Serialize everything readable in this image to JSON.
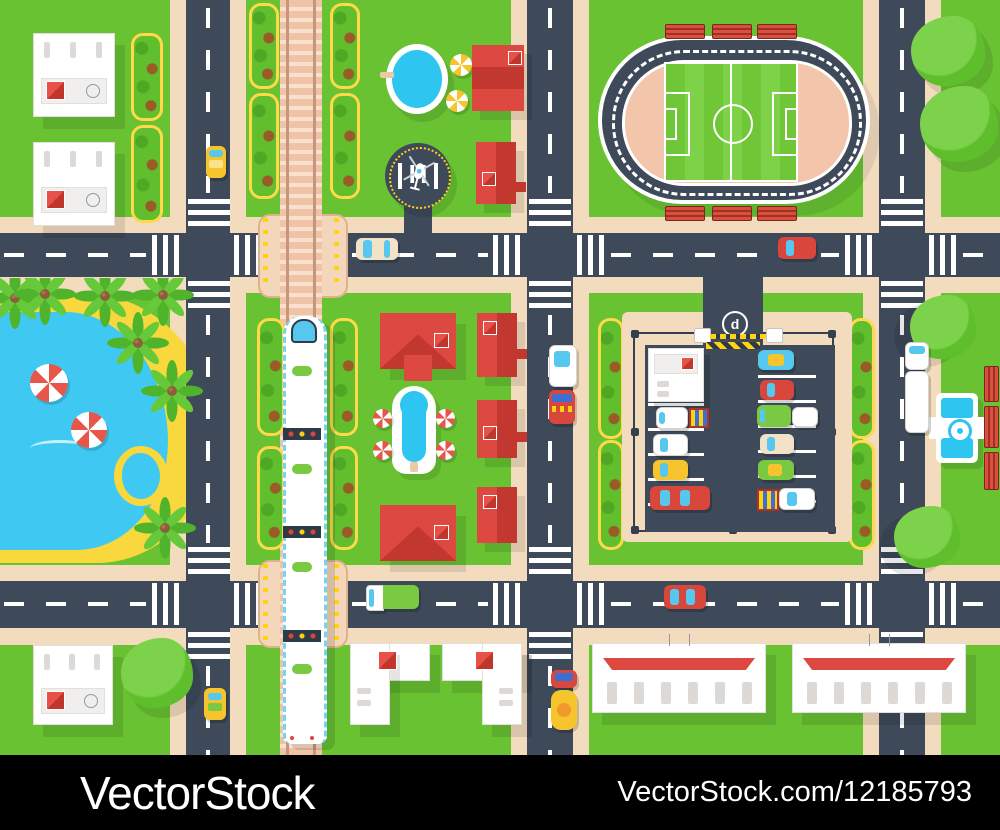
{
  "page": {
    "type": "stock-vector-preview",
    "subject": "City map top view with roads, railway train, stadium, parking lot, beach and buildings"
  },
  "watermark": {
    "brand_text": "VectorStock",
    "id_text": "VectorStock.com/12185793",
    "bar_color": "#000000",
    "text_color": "#FFFFFF"
  },
  "map": {
    "signs": {
      "helipad_letter": "H",
      "parking_sign_letter": "d"
    },
    "palette": {
      "grass": "#68C232",
      "grass_stripe": "#77CD40",
      "road": "#3E4A5A",
      "road_marking": "#FFFFFF",
      "sidewalk": "#F3DCBE",
      "rail_tie": "#EFC3A8",
      "water": "#3FC9F2",
      "sand": "#F8D83C",
      "roof_red": "#DD4840",
      "roof_red_dark": "#C23830",
      "building_white": "#FFFFFF",
      "hedge_border_yellow": "#FFD94A",
      "stadium_infield": "#F3C6AB",
      "bench_red": "#D9503F",
      "taxi_yellow": "#F6C52E",
      "train_accent_green": "#7AC943",
      "window_cyan": "#56C8F0",
      "gate_yellow": "#FFD213"
    }
  }
}
